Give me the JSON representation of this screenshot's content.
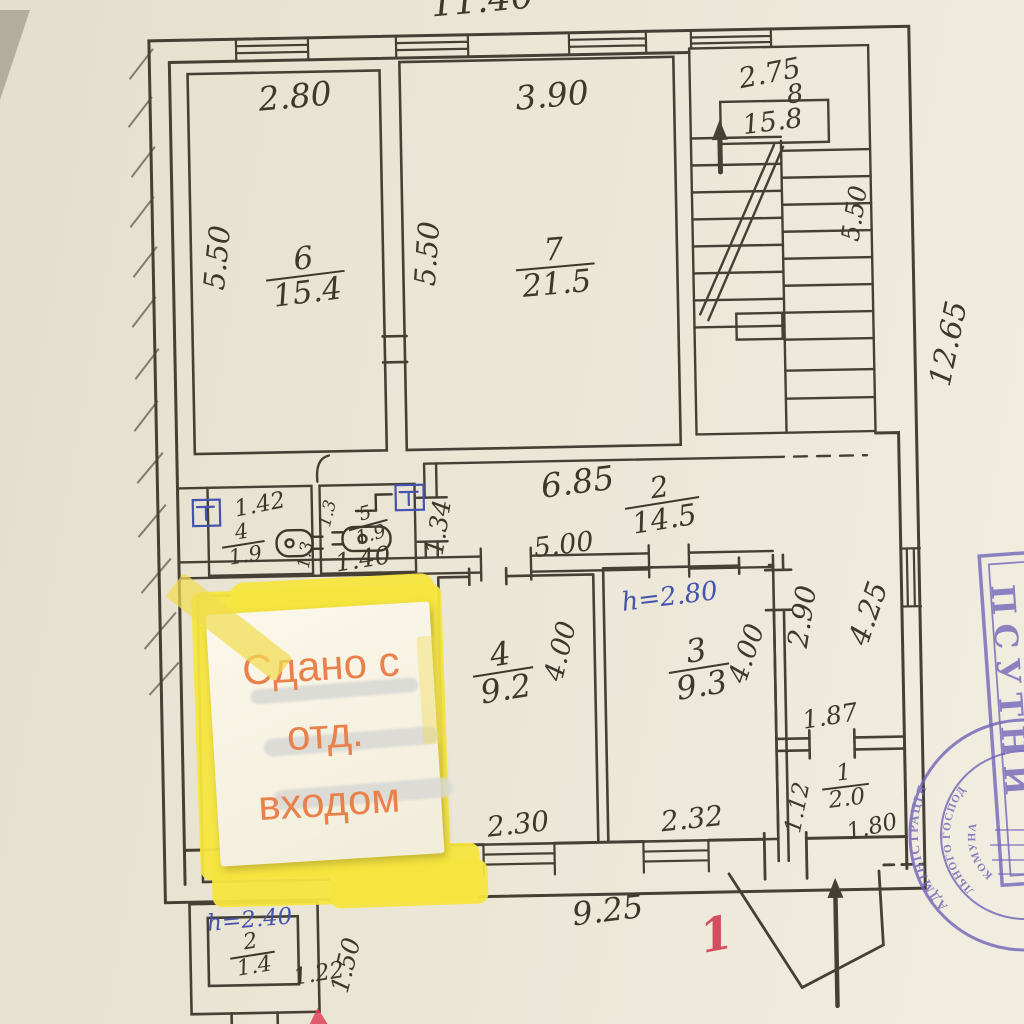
{
  "document_type": "hand-drawn apartment floor plan (scanned photo)",
  "note": {
    "line1": "Сдано с",
    "line2": "отд.",
    "line3": "входом"
  },
  "rooms": {
    "r6": {
      "number": "6",
      "area": "15.4"
    },
    "r7": {
      "number": "7",
      "area": "21.5"
    },
    "r8": {
      "number": "8",
      "area": "15.8"
    },
    "wc": {
      "number": "4",
      "area": "1.9"
    },
    "r5": {
      "number": "5",
      "area": "1.9"
    },
    "corridor": {
      "number": "2",
      "area": "14.5"
    },
    "r4": {
      "number": "4",
      "area": "9.2"
    },
    "r3": {
      "number": "3",
      "area": "9.3"
    },
    "r1": {
      "number": "1",
      "area": "2.0"
    },
    "tambour": {
      "number": "2",
      "area": "1.4"
    }
  },
  "dims": {
    "top": "11.40",
    "r6w": "2.80",
    "r7w": "3.90",
    "stairw": "2.75",
    "r6h": "5.50",
    "r7h": "5.50",
    "stairh": "5.50",
    "rightwall": "12.65",
    "wcw": "1.42",
    "d13a": "1.3",
    "d13b": "1.3",
    "r5w": "1.40",
    "hall": "1.34",
    "corrw": "6.85",
    "corrlen": "5.00",
    "r4h": "4.00",
    "r3h": "4.00",
    "r4w": "2.30",
    "r3w": "2.32",
    "rc290": "2.90",
    "rc425": "4.25",
    "d187": "1.87",
    "d112": "1.12",
    "r1w": "1.80",
    "bottomw": "9.25",
    "tamw": "1.22",
    "tamd": "1.50"
  },
  "heights": {
    "room3": "h=2.80",
    "tambour": "h=2.40"
  },
  "marks": {
    "entrance": "1"
  },
  "stamp": {
    "arc1": "АДМІНІСТРАЦІЯ",
    "arc2": "ЛЬНОГО ГОСПОДА",
    "arc3": "КОМУНА",
    "vertical": "ПСУТНИ"
  },
  "colors": {
    "paper": "#ebe6d6",
    "ink": "#3e382b",
    "blue_ink": "#4553ae",
    "red_ink": "#d14f60",
    "stamp_purple": "#6f63b8",
    "note_yellow": "#f6e53e",
    "note_text_orange": "#e8814b"
  }
}
